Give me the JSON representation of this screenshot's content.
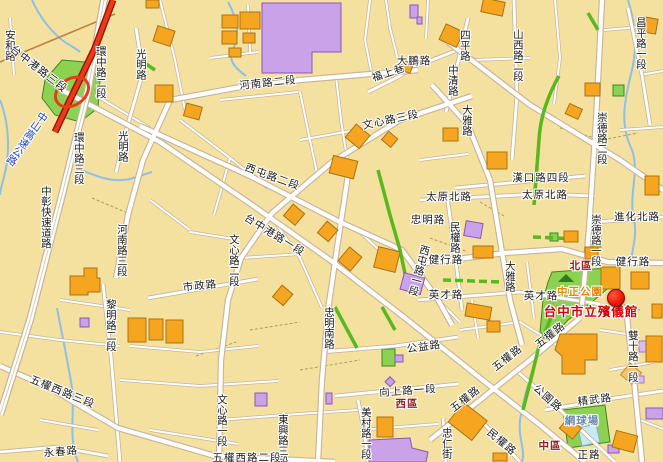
{
  "map": {
    "colors": {
      "land": "#F4E1A0",
      "road_fill": "#FFFFFF",
      "road_casing": "#C9B49A",
      "building": "#F5A51F",
      "building_outline": "#A97313",
      "campus": "#C9A2E8",
      "park": "#8CD152",
      "green_road": "#58B81E",
      "river": "#8FBEE6",
      "highway_red": "#E63C18",
      "marker_red": "#EE1506",
      "poi_text": "#D40000",
      "district_text": "#9B1B1B",
      "park_text": "#E8860A",
      "court_text": "#6888B0",
      "highway_text": "#2244CC"
    },
    "streets": [
      {
        "t": "安和路",
        "x": 9,
        "y": 45,
        "o": "v"
      },
      {
        "t": "台中港路三段",
        "x": 38,
        "y": 70,
        "o": 38
      },
      {
        "t": "環中路二段",
        "x": 100,
        "y": 72,
        "o": "v"
      },
      {
        "t": "光明路",
        "x": 140,
        "y": 64,
        "o": "v"
      },
      {
        "t": "光明路",
        "x": 122,
        "y": 146,
        "o": "v"
      },
      {
        "t": "環中路三段",
        "x": 78,
        "y": 158,
        "o": "v"
      },
      {
        "t": "中山高速公路",
        "x": 26,
        "y": 138,
        "o": "v",
        "rot": 35,
        "c": "hwy"
      },
      {
        "t": "中彰快速道路",
        "x": 45,
        "y": 217,
        "o": "v"
      },
      {
        "t": "河南路二段",
        "x": 268,
        "y": 84,
        "o": -6
      },
      {
        "t": "福上巷",
        "x": 389,
        "y": 74,
        "o": -18
      },
      {
        "t": "大鵬路",
        "x": 414,
        "y": 62,
        "o": 0
      },
      {
        "t": "文心路三段",
        "x": 391,
        "y": 121,
        "o": -12
      },
      {
        "t": "四平路",
        "x": 464,
        "y": 45,
        "o": "v"
      },
      {
        "t": "中清路",
        "x": 452,
        "y": 80,
        "o": "v"
      },
      {
        "t": "大雅路",
        "x": 466,
        "y": 120,
        "o": "v"
      },
      {
        "t": "山西路二段",
        "x": 517,
        "y": 55,
        "o": "v"
      },
      {
        "t": "昌平路一段",
        "x": 640,
        "y": 43,
        "o": "v"
      },
      {
        "t": "崇德路二段",
        "x": 601,
        "y": 138,
        "o": "v"
      },
      {
        "t": "漢口路四段",
        "x": 541,
        "y": 179,
        "o": 0
      },
      {
        "t": "太原北路",
        "x": 449,
        "y": 198,
        "o": 0
      },
      {
        "t": "太原北路",
        "x": 545,
        "y": 196,
        "o": 0
      },
      {
        "t": "進化北路",
        "x": 637,
        "y": 218,
        "o": 0
      },
      {
        "t": "忠明路",
        "x": 428,
        "y": 221,
        "o": 0
      },
      {
        "t": "民權路",
        "x": 454,
        "y": 237,
        "o": "v"
      },
      {
        "t": "崇德路一段",
        "x": 595,
        "y": 240,
        "o": "v"
      },
      {
        "t": "健行路",
        "x": 446,
        "y": 261,
        "o": 0
      },
      {
        "t": "健行路",
        "x": 633,
        "y": 263,
        "o": 0
      },
      {
        "t": "西屯路二段",
        "x": 272,
        "y": 178,
        "o": 20
      },
      {
        "t": "台中港路一段",
        "x": 274,
        "y": 236,
        "o": 32
      },
      {
        "t": "文心路二段",
        "x": 233,
        "y": 260,
        "o": "v"
      },
      {
        "t": "西屯路一段",
        "x": 418,
        "y": 270,
        "o": "v",
        "rot": 15
      },
      {
        "t": "河南路三段",
        "x": 121,
        "y": 250,
        "o": "v"
      },
      {
        "t": "市政路",
        "x": 200,
        "y": 287,
        "o": -6
      },
      {
        "t": "大雅路",
        "x": 509,
        "y": 276,
        "o": "v"
      },
      {
        "t": "英才路",
        "x": 446,
        "y": 296,
        "o": 0
      },
      {
        "t": "英才路",
        "x": 541,
        "y": 297,
        "o": 0
      },
      {
        "t": "黎明路二段",
        "x": 110,
        "y": 325,
        "o": "v"
      },
      {
        "t": "五權西路三段",
        "x": 62,
        "y": 393,
        "o": 22
      },
      {
        "t": "忠明南路",
        "x": 328,
        "y": 328,
        "o": "v"
      },
      {
        "t": "公益路",
        "x": 424,
        "y": 348,
        "o": -8
      },
      {
        "t": "向上路一段",
        "x": 408,
        "y": 392,
        "o": -4
      },
      {
        "t": "文心路一段",
        "x": 221,
        "y": 420,
        "o": "v"
      },
      {
        "t": "東興路三段",
        "x": 282,
        "y": 440,
        "o": "v"
      },
      {
        "t": "美村路一段",
        "x": 365,
        "y": 433,
        "o": "v"
      },
      {
        "t": "永春路",
        "x": 61,
        "y": 453,
        "o": -5
      },
      {
        "t": "五權西路二段",
        "x": 247,
        "y": 459,
        "o": 0
      },
      {
        "t": "五權路",
        "x": 551,
        "y": 336,
        "o": -38
      },
      {
        "t": "五權路",
        "x": 508,
        "y": 359,
        "o": -38
      },
      {
        "t": "五權路",
        "x": 466,
        "y": 400,
        "o": -38
      },
      {
        "t": "公園路",
        "x": 547,
        "y": 399,
        "o": 42
      },
      {
        "t": "民權路",
        "x": 501,
        "y": 443,
        "o": 40
      },
      {
        "t": "忠仁街",
        "x": 446,
        "y": 443,
        "o": "v"
      },
      {
        "t": "雙十路一段",
        "x": 632,
        "y": 356,
        "o": "v"
      },
      {
        "t": "精武路",
        "x": 595,
        "y": 401,
        "o": -7
      },
      {
        "t": "正路",
        "x": 589,
        "y": 456,
        "o": 0
      }
    ],
    "districts": [
      {
        "t": "北區",
        "x": 581,
        "y": 267
      },
      {
        "t": "西區",
        "x": 407,
        "y": 405
      },
      {
        "t": "中區",
        "x": 550,
        "y": 447
      }
    ],
    "parks": [
      {
        "t": "中正公園",
        "x": 580,
        "y": 293
      },
      {
        "t": "網球場",
        "x": 582,
        "y": 422,
        "c": "court"
      }
    ],
    "poi": {
      "label": {
        "t": "台中市立殯儀館",
        "x": 591,
        "y": 312
      },
      "marker": {
        "x": 616,
        "y": 298
      }
    }
  }
}
